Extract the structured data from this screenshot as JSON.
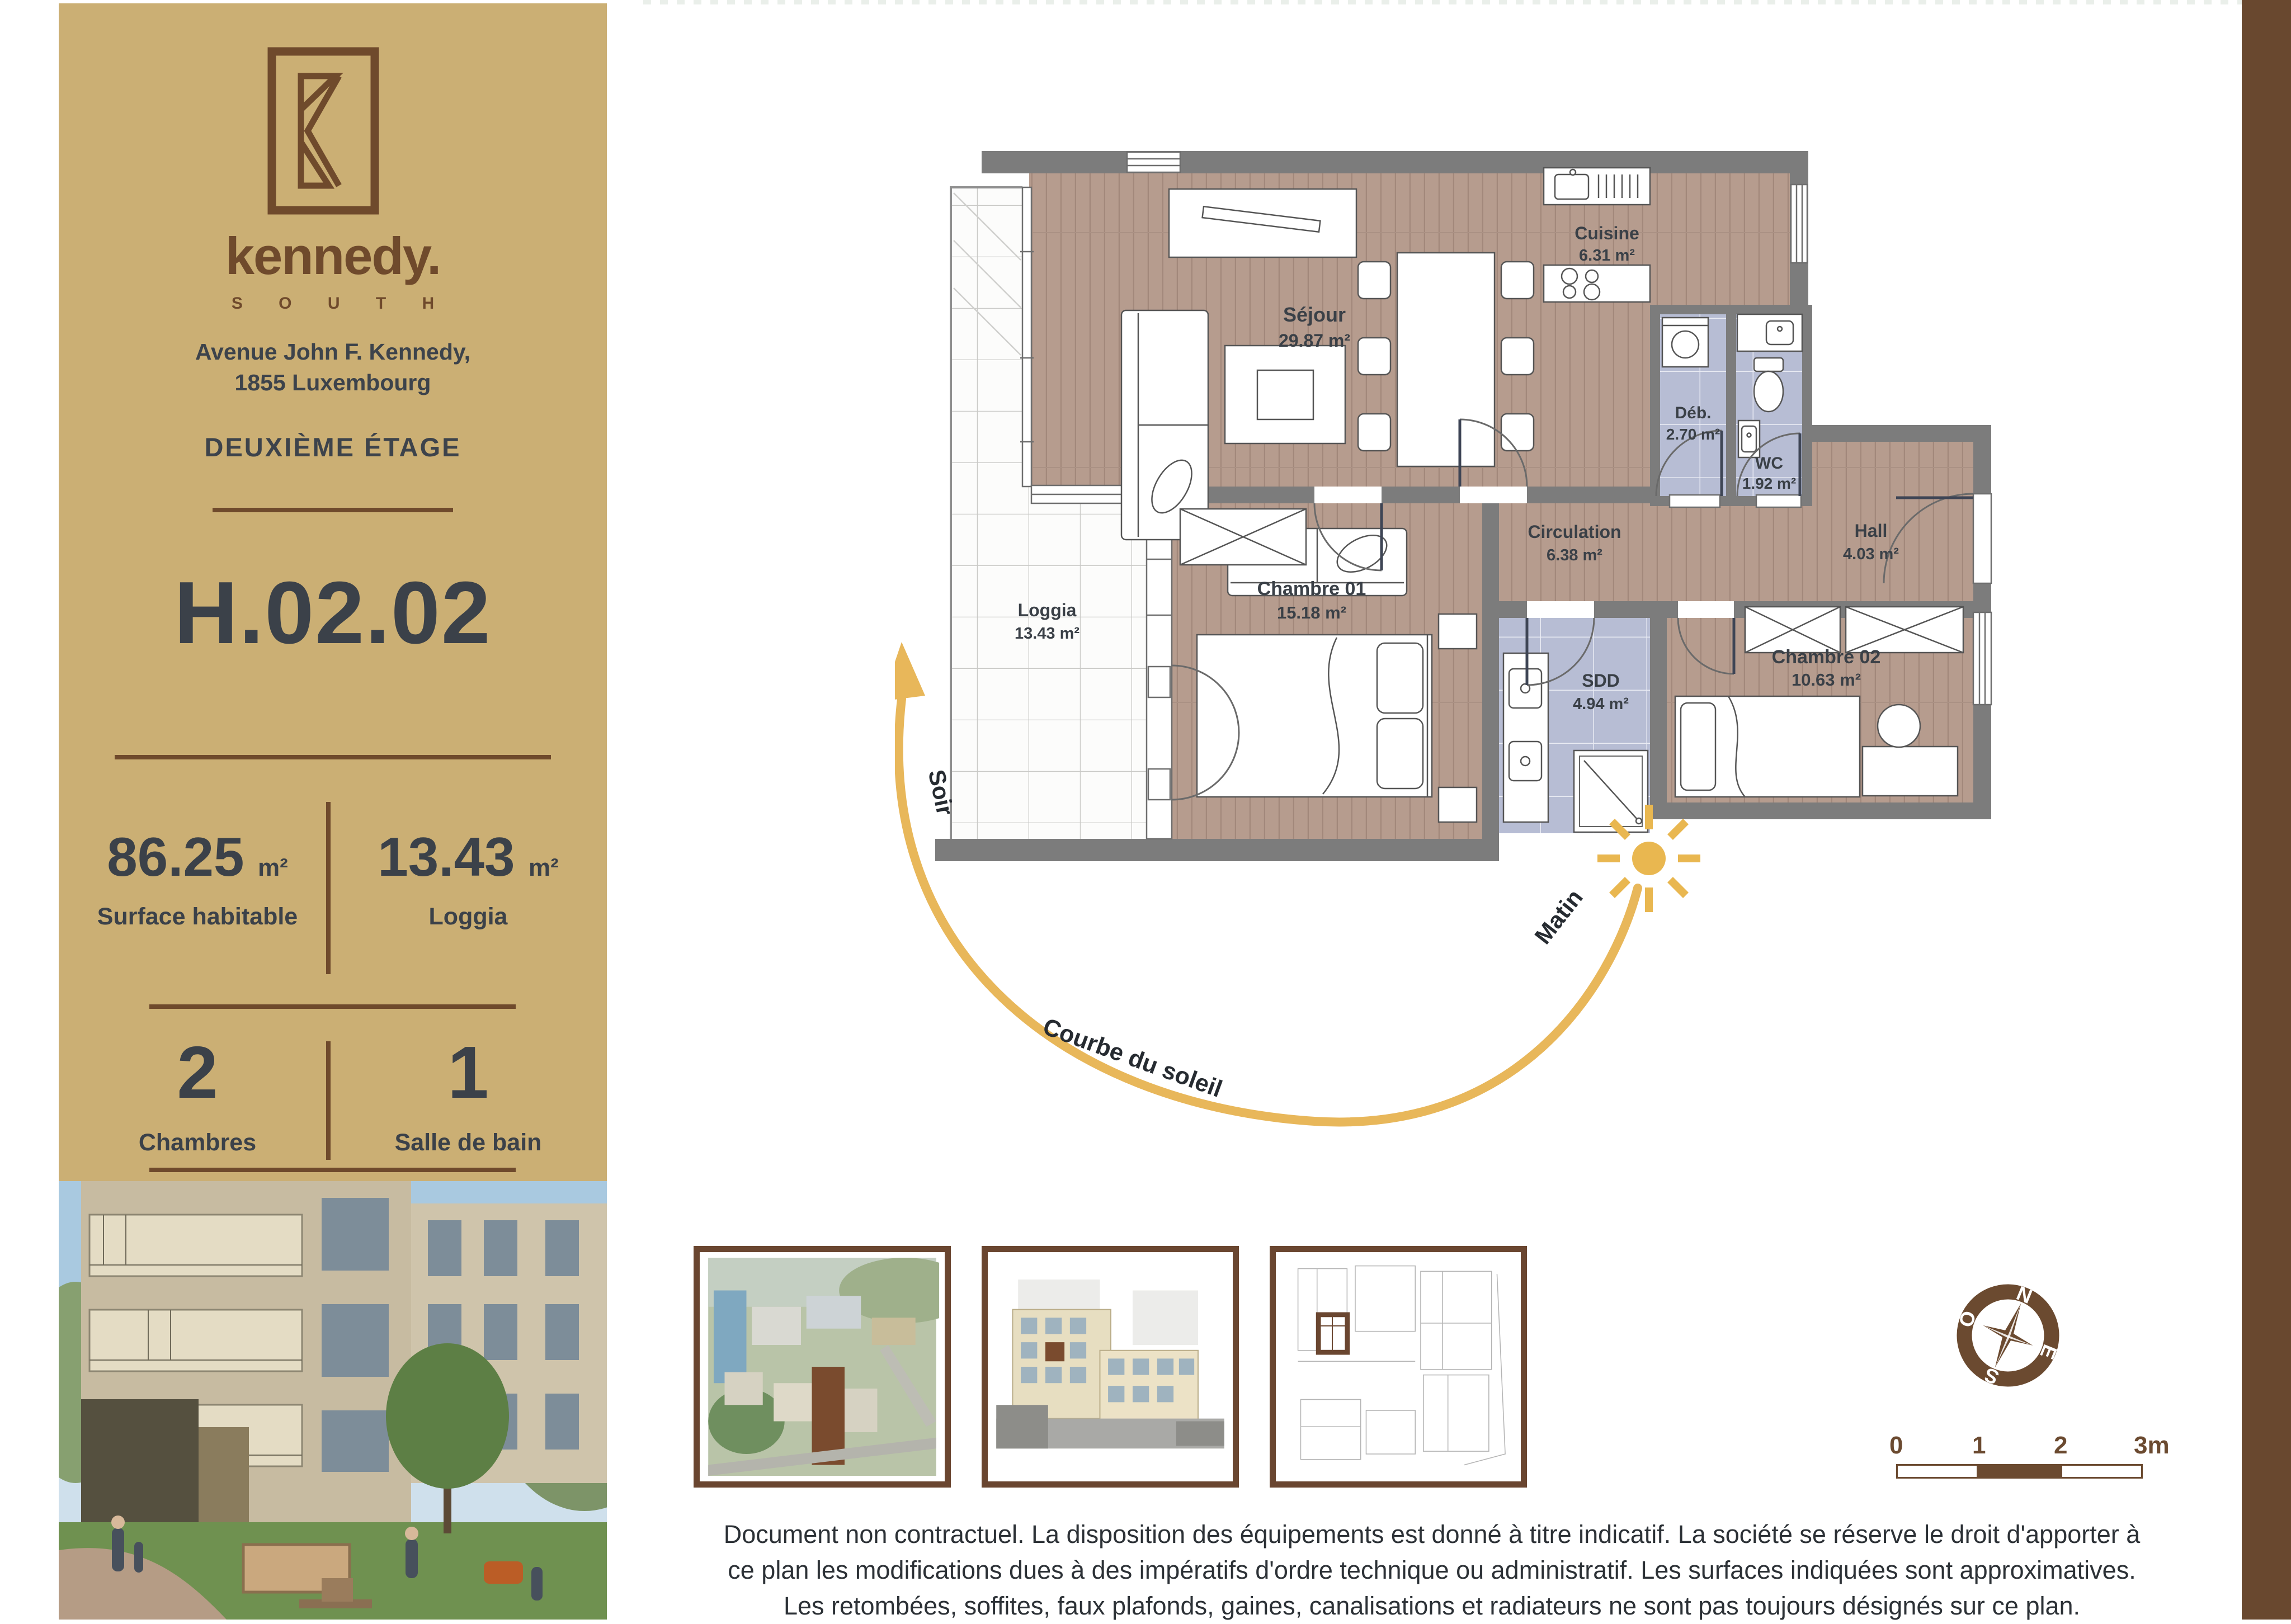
{
  "sidebar": {
    "brand": "kennedy.",
    "brand_sub": "S O U T H",
    "address_line1": "Avenue John F. Kennedy,",
    "address_line2": "1855 Luxembourg",
    "floor_label": "DEUXIÈME ÉTAGE",
    "unit_code": "H.02.02",
    "stats": [
      {
        "value": "86.25",
        "unit": "m²",
        "label": "Surface habitable"
      },
      {
        "value": "13.43",
        "unit": "m²",
        "label": "Loggia"
      }
    ],
    "counts": [
      {
        "value": "2",
        "label": "Chambres"
      },
      {
        "value": "1",
        "label": "Salle de bain"
      }
    ]
  },
  "plan": {
    "rooms": [
      {
        "name": "Séjour",
        "area": "29.87 m²"
      },
      {
        "name": "Cuisine",
        "area": "6.31 m²"
      },
      {
        "name": "Déb.",
        "area": "2.70 m²"
      },
      {
        "name": "WC",
        "area": "1.92 m²"
      },
      {
        "name": "Circulation",
        "area": "6.38 m²"
      },
      {
        "name": "Hall",
        "area": "4.03 m²"
      },
      {
        "name": "Chambre 01",
        "area": "15.18 m²"
      },
      {
        "name": "SDD",
        "area": "4.94 m²"
      },
      {
        "name": "Chambre 02",
        "area": "10.63 m²"
      },
      {
        "name": "Loggia",
        "area": "13.43 m²"
      }
    ],
    "sun_curve": {
      "evening": "Soir",
      "morning": "Matin",
      "label": "Courbe du soleil"
    }
  },
  "compass": {
    "n": "N",
    "e": "E",
    "s": "S",
    "w": "O"
  },
  "scale_bar": {
    "ticks": [
      "0",
      "1",
      "2",
      "3m"
    ]
  },
  "footer": {
    "disclaimer": "Document non contractuel. La disposition des équipements est donné à titre indicatif. La société se réserve le droit d'apporter à ce plan les modifications dues à des impératifs d'ordre technique ou administratif. Les surfaces indiquées sont approximatives. Les retombées, soffites, faux plafonds, gaines, canalisations et radiateurs ne sont pas toujours désignés sur ce plan."
  },
  "colors": {
    "sidebar_bg": "#cbaf74",
    "brand_brown": "#6f4a2c",
    "text_dark": "#3d434b",
    "wall_gray": "#7c7c7c",
    "floor_wood": "#b69c8e",
    "floor_tile_blue": "#b7bdd4",
    "accent_gold": "#e8b75a",
    "stripe_brown": "#69482f"
  }
}
